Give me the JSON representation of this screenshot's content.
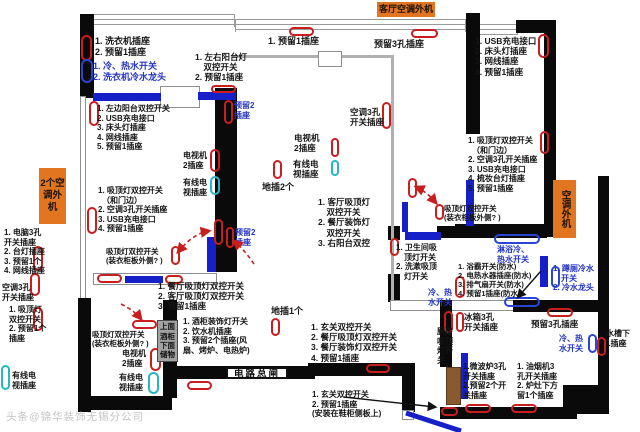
{
  "badges": {
    "living_ac": "客厅空调外机",
    "left_ac": "2个空调外机",
    "right_ac": "空调外机"
  },
  "boxes": {
    "cabinet": "上面酒柜下面储物",
    "breaker": "电路总闸"
  },
  "notes": {
    "washer": "1. 洗衣机插座\n2. 预留1插座",
    "washer_water": "1. 冷、热水开关\n2. 洗衣机冷水龙头",
    "bedroom1_wall_list": "1. 左边阳台双控开关\n2. USB充电接口\n3. 床头灯插座\n4. 网线插座\n5. 预留1插座",
    "bedroom1_tv": "电视机\n2插座",
    "bedroom1_cable": "有线电\n视插座",
    "bedroom1_switch_list": "1. 吸顶灯双控开关\n　（和门边）\n2. 空调3孔开关插座\n3. USB充电接口\n4. 预留1插座",
    "bedroom1_wardrobe_switch": "吸顶灯双控开关\n(装衣柜板外侧? )",
    "study_list": "1. 电脑3孔\n开关插座\n2. 台灯插座\n3. 预留1个\n4. 网线插座",
    "study_ac": "空调3孔\n开关插座",
    "study_switch": "1. 吸顶灯\n双控开关\n2. 预留1个\n插座",
    "study_cable": "有线电\n视插座",
    "bedroom3_wardrobe_switch": "吸顶灯双控开关\n(装衣柜板外侧? )",
    "bedroom3_tv": "电视机\n2插座",
    "bedroom3_cable": "有线电\n视插座",
    "balcony_mid": "1. 左右阳台灯\n　双控开关\n2. 预留1插座",
    "reserved2_top": "预留2\n插座",
    "reserved2_mid": "预留2\n插座",
    "top_reserved1": "1. 预留1插座",
    "top_reserved3hole": "预留3孔插座",
    "living_ac_socket": "空调3孔\n开关插座",
    "living_tv": "电视机\n2插座",
    "living_cable": "有线电\n视插座",
    "floor_socket_2": "地插2个",
    "living_switch_list": "1. 客厅吸顶灯\n　双控开关\n2. 餐厅装饰灯\n　双控开关\n3. 右阳台双控",
    "dining_switch_list": "1. 餐厅吸顶灯双控开关\n2. 客厅吸顶灯双控开关\n3. 预留1插座",
    "cabinet_list": "1. 酒柜装饰灯开关\n2. 饮水机插座\n3. 预留2个插座(风\n扇、烤炉、电热炉)",
    "floor_socket_1": "地插1个",
    "entry_switch_list": "1. 玄关双控开关\n2. 餐厅吸顶灯双控开关\n3. 餐厅装饰灯双控开关\n4. 预留1插座",
    "entry_shoe_cabinet": "1. 玄关双控开关\n2. 预留1插座\n(安装在鞋柜侧板上)",
    "bedroom2_wall_list": "1. USB充电接口\n2. 床头灯插座\n3. 网线插座\n4. 预留1插座",
    "bedroom2_switch_list": "1. 吸顶灯双控开关\n　（和门边）\n2. 空调3孔开关插座\n3. USB充电接口\n4. 梳妆台灯插座\n5. 预留1插座",
    "bedroom2_wardrobe_switch": "吸顶灯双控开关\n(装衣柜板外侧? )",
    "bath_light_switch": "1. 卫生间吸\n　顶灯开关\n2. 洗漱吸顶\n　灯开关",
    "bath_device_list": "1. 浴霸开关(防水)\n2. 电热水器插座(防水)\n3. 排气扇开关(防水)\n4. 预留1插座(防水)",
    "shower_water": "淋浴冷、\n热水开关",
    "bath_water": "冷、热\n水开关",
    "toilet_water": "1. 蹲厕冷水\n　开关\n2. 冷水龙头",
    "kitchen_reserved3": "预留3孔插座",
    "kitchen_water": "冷、热\n水开关",
    "sink_socket": "水槽下\n1插座",
    "fridge_socket": "冰箱3孔\n开关插座",
    "kitchen_light_switch": "厨房吸顶灯开关",
    "microwave_list": "1.微波炉3孔\n开关插座\n2.预留2个开\n关插座",
    "hood_list": "1. 油烟机3\n孔开关插座\n2. 炉灶下方\n留1个插座"
  },
  "watermark": "头条@锦华装饰无锡分公司",
  "colors": {
    "socket_marker": "#c81e1e",
    "water_marker": "#2946d2",
    "cable_marker": "#27b6c6",
    "badge": "#e2751f",
    "wall": "#0a0a0a",
    "wood_door": "#8a5a2f",
    "window_door": "#1620c8"
  }
}
